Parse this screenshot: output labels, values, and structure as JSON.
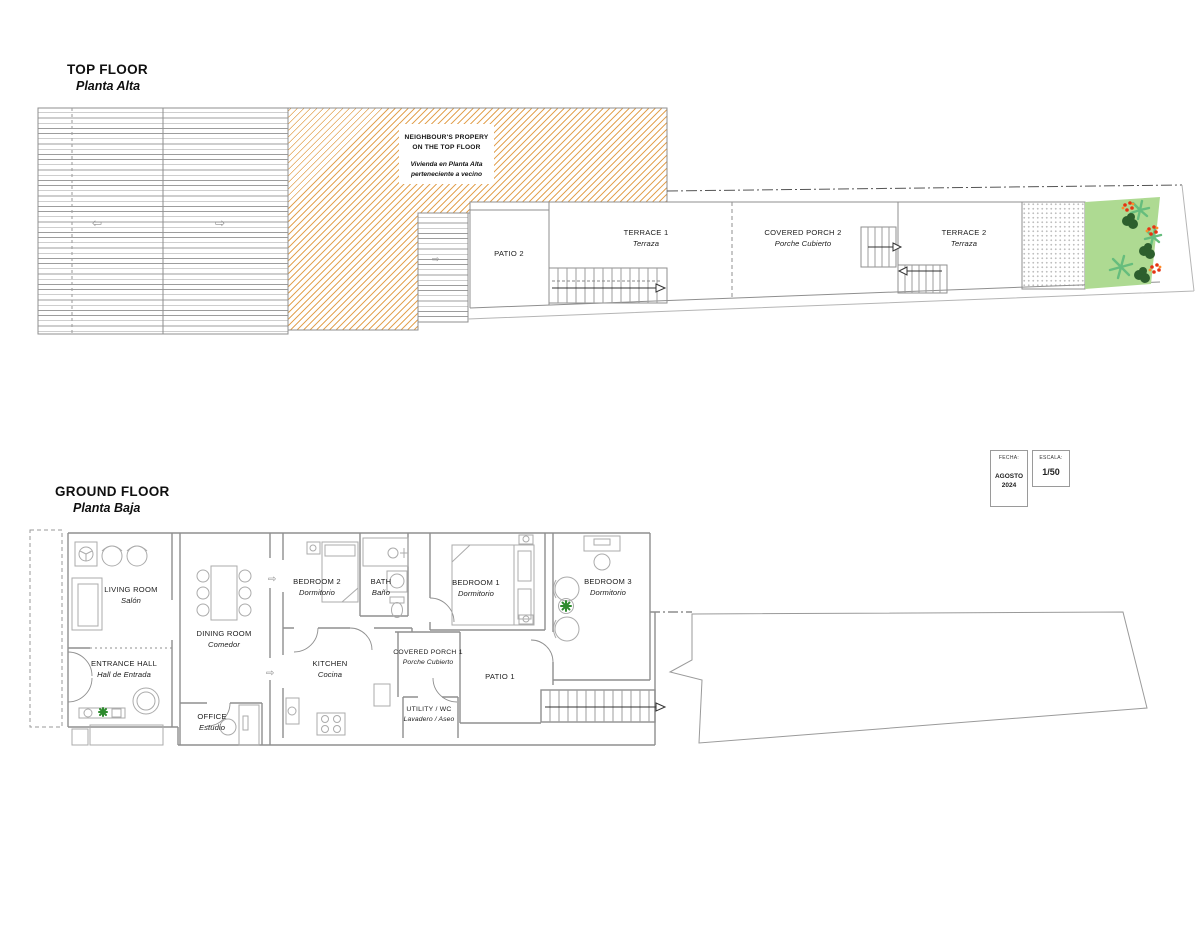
{
  "top_floor": {
    "title": "TOP FLOOR",
    "subtitle": "Planta Alta",
    "neighbour_note": {
      "en1": "NEIGHBOUR'S PROPERY",
      "en2": "ON THE TOP FLOOR",
      "es1": "Vivienda en Planta Alta",
      "es2": "perteneciente a vecino"
    },
    "rooms": {
      "patio2": {
        "name": "PATIO 2"
      },
      "terrace1": {
        "name": "TERRACE 1",
        "subtitle": "Terraza"
      },
      "covered_porch2": {
        "name": "COVERED PORCH 2",
        "subtitle": "Porche Cubierto"
      },
      "terrace2": {
        "name": "TERRACE 2",
        "subtitle": "Terraza"
      }
    }
  },
  "ground_floor": {
    "title": "GROUND FLOOR",
    "subtitle": "Planta Baja",
    "rooms": {
      "living_room": {
        "name": "LIVING ROOM",
        "subtitle": "Salón"
      },
      "entrance_hall": {
        "name": "ENTRANCE HALL",
        "subtitle": "Hall de Entrada"
      },
      "dining_room": {
        "name": "DINING ROOM",
        "subtitle": "Comedor"
      },
      "office": {
        "name": "OFFICE",
        "subtitle": "Estudio"
      },
      "bedroom2": {
        "name": "BEDROOM 2",
        "subtitle": "Dormitorio"
      },
      "bath": {
        "name": "BATH",
        "subtitle": "Baño"
      },
      "kitchen": {
        "name": "KITCHEN",
        "subtitle": "Cocina"
      },
      "covered_porch1": {
        "name": "COVERED PORCH 1",
        "subtitle": "Porche Cubierto"
      },
      "utility": {
        "name": "UTILITY / WC",
        "subtitle": "Lavadero / Aseo"
      },
      "bedroom1": {
        "name": "BEDROOM 1",
        "subtitle": "Dormitorio"
      },
      "bedroom3": {
        "name": "BEDROOM 3",
        "subtitle": "Dormitorio"
      },
      "patio1": {
        "name": "PATIO 1"
      }
    }
  },
  "title_block": {
    "date_label": "FECHA:",
    "date_month": "AGOSTO",
    "date_year": "2024",
    "scale_label": "ESCALA:",
    "scale_value": "1/50"
  },
  "icons": {
    "slope_arrow_left": "⇦",
    "slope_arrow_right": "⇨",
    "flow_arrow": "⇨"
  },
  "colors": {
    "hatch_orange": "#e3a455",
    "roof_line": "#9d9d9d",
    "wall_gray": "#8f8f8f",
    "garden_green": "#aeda92",
    "palm_green": "#66bd7d",
    "bush_green": "#2d5f2d",
    "flower_red": "#e63312",
    "flower_orange": "#ff8c2a",
    "plant_green": "#2e8b2e"
  }
}
